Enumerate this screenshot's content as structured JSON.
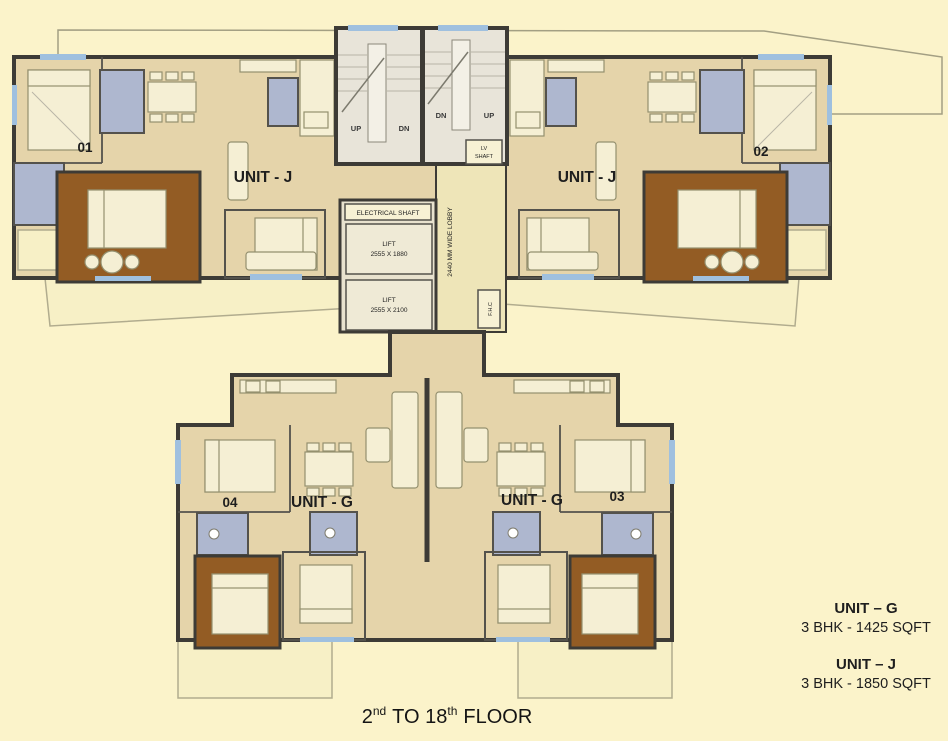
{
  "colors": {
    "background": "#FBF3CA",
    "unit_floor": "#E5D4AA",
    "wall": "#3D3B36",
    "bathroom": "#AEB7CF",
    "master_bedroom_floor": "#935C24",
    "balcony": "#F7F0C6",
    "staircase": "#E8E4D9",
    "lobby": "#EEE5B8",
    "window": "#9FC0DF"
  },
  "units": {
    "u01": "01",
    "u02": "02",
    "u03": "03",
    "u04": "04",
    "unit_j": "UNIT - J",
    "unit_g": "UNIT - G"
  },
  "core": {
    "electrical_shaft": "ELECTRICAL SHAFT",
    "lift_label": "LIFT",
    "lift1_size": "2555 X 1880",
    "lift2_size": "2555 X 2100",
    "lobby_label": "2440 MM WIDE LOBBY",
    "lv_line1": "LV",
    "lv_line2": "SHAFT",
    "fhc": "F.H.C",
    "up": "UP",
    "dn": "DN"
  },
  "legend": {
    "g_title": "UNIT – G",
    "g_spec": "3 BHK - 1425 SQFT",
    "j_title": "UNIT – J",
    "j_spec": "3 BHK - 1850 SQFT"
  },
  "floor_line": {
    "n1": "2",
    "s1": "nd",
    "mid": "TO 18",
    "s2": "th",
    "tail": "FLOOR"
  }
}
